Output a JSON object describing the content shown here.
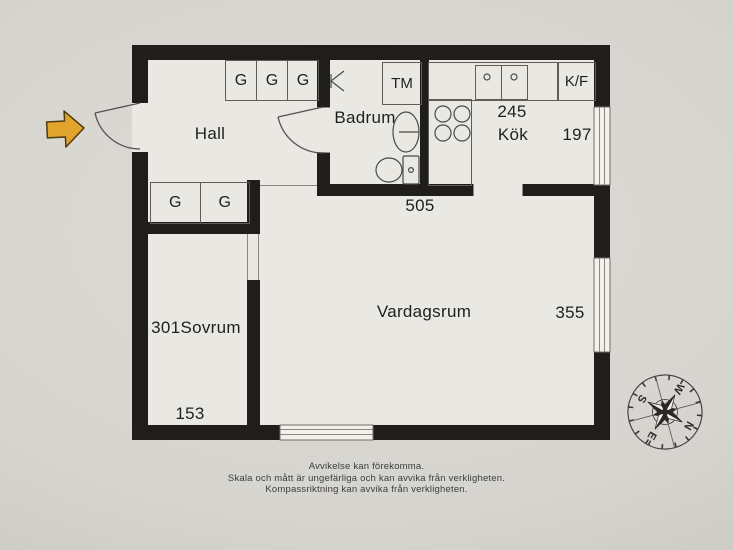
{
  "colors": {
    "bg": "#d6d4ce",
    "floor": "#eae8e2",
    "wall": "#201e1c",
    "line": "#5f5d57",
    "ink": "#1f1f1f",
    "win": "#f3f1eb",
    "accent": "#e2a42c"
  },
  "rooms": {
    "hall": {
      "label": "Hall"
    },
    "badrum": {
      "label": "Badrum"
    },
    "kok": {
      "label": "Kök",
      "dim_w": "245",
      "dim_h": "197"
    },
    "vardagsrum": {
      "label": "Vardagsrum",
      "dim_w": "505",
      "dim_h": "355"
    },
    "sovrum": {
      "label": "Sovrum",
      "number": "301",
      "dim_w": "153"
    }
  },
  "fixtures": {
    "washing_machine": "TM",
    "fridge_freezer": "K/F",
    "hall_wardrobes_top": [
      "G",
      "G",
      "G"
    ],
    "hall_wardrobes_lower": [
      "G",
      "G"
    ]
  },
  "compass": {
    "n": "N",
    "e": "E",
    "s": "S",
    "w": "W"
  },
  "disclaimer": {
    "line1": "Avvikelse kan förekomma.",
    "line2": "Skala och mått är ungefärliga och kan avvika från verkligheten.",
    "line3": "Kompassriktning kan avvika från verkligheten."
  }
}
